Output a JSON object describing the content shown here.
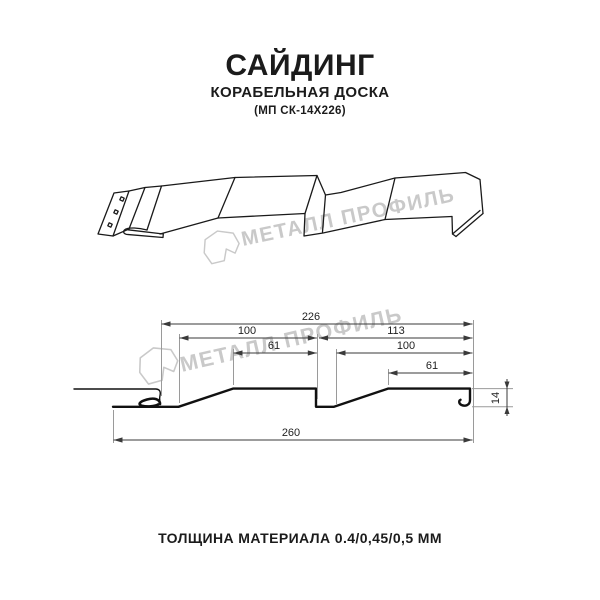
{
  "title": {
    "main": "САЙДИНГ",
    "subtitle": "КОРАБЕЛЬНАЯ ДОСКА",
    "model": "(МП СК-14Х226)"
  },
  "watermark": {
    "brand": "МЕТАЛЛ ПРОФИЛЬ",
    "logo_icon": "metal-profil-logo",
    "color": "#c9c9c9"
  },
  "drawing": {
    "type": "siding-profile-technical-drawing",
    "dim_labels": {
      "d226": "226",
      "d100a": "100",
      "d113": "113",
      "d61a": "61",
      "d100b": "100",
      "d61b": "61",
      "d260": "260",
      "d14": "14"
    }
  },
  "footer": {
    "thickness_label": "ТОЛЩИНА МАТЕРИАЛА 0.4/0,45/0,5 ММ"
  }
}
